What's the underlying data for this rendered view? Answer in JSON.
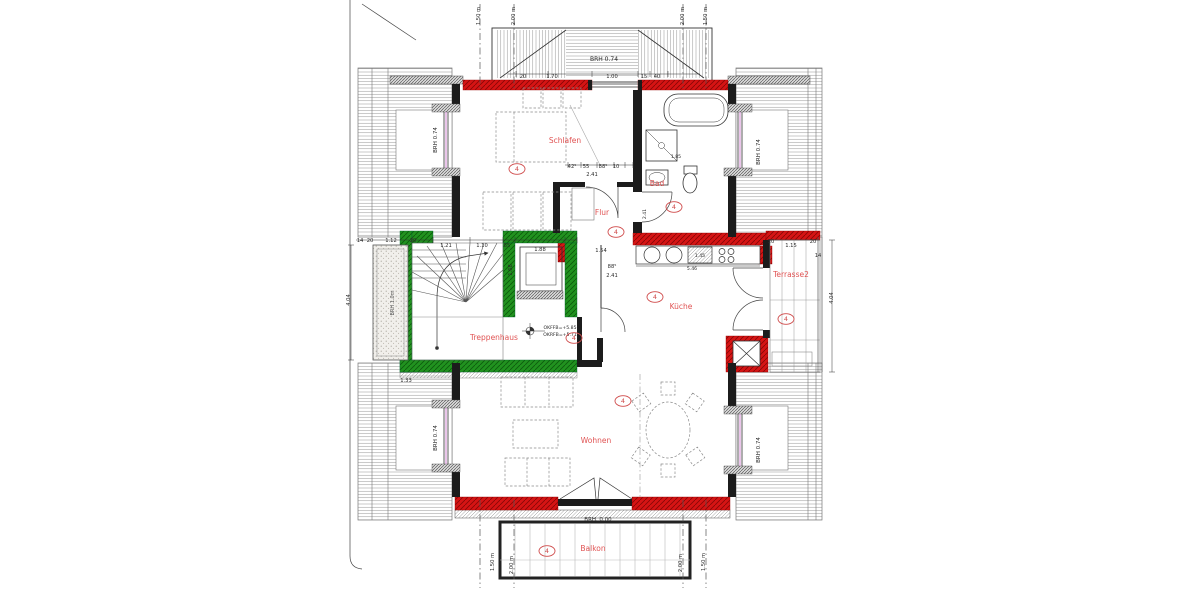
{
  "meta": {
    "title": "Dachgeschoss Wohnungsgrundriss"
  },
  "colors": {
    "wall_red": "#d61414",
    "wall_red_hatch": "#8a0606",
    "wall_green": "#21921f",
    "wall_green_hatch": "#0c5c0c",
    "room_text": "#e05353",
    "marker": "#cf4a4a",
    "ink": "#2b2b2b",
    "roof_line": "#8f8f8f",
    "glass": "#c45ac4"
  },
  "labels": {
    "rooms": [
      {
        "id": "schlafen",
        "label": "Schlafen",
        "x": 565,
        "y": 143
      },
      {
        "id": "bad",
        "label": "Bad",
        "x": 657,
        "y": 186
      },
      {
        "id": "flur",
        "label": "Flur",
        "x": 602,
        "y": 215
      },
      {
        "id": "kueche",
        "label": "Küche",
        "x": 681,
        "y": 309
      },
      {
        "id": "treppenhaus",
        "label": "Treppenhaus",
        "x": 494,
        "y": 340
      },
      {
        "id": "wohnen",
        "label": "Wohnen",
        "x": 596,
        "y": 443
      },
      {
        "id": "balkon",
        "label": "Balkon",
        "x": 593,
        "y": 551
      },
      {
        "id": "terrasse2",
        "label": "Terrasse2",
        "x": 791,
        "y": 277
      }
    ],
    "markers": [
      {
        "text": "4",
        "x": 517,
        "y": 169
      },
      {
        "text": "4",
        "x": 674,
        "y": 207
      },
      {
        "text": "4",
        "x": 616,
        "y": 232
      },
      {
        "text": "4",
        "x": 655,
        "y": 297
      },
      {
        "text": "4",
        "x": 574,
        "y": 338
      },
      {
        "text": "4",
        "x": 623,
        "y": 401
      },
      {
        "text": "4",
        "x": 547,
        "y": 551
      },
      {
        "text": "4",
        "x": 786,
        "y": 319
      }
    ],
    "dims": [
      {
        "t": "20",
        "x": 523,
        "y": 78
      },
      {
        "t": "1.70",
        "x": 552,
        "y": 78
      },
      {
        "t": "1.00",
        "x": 612,
        "y": 78
      },
      {
        "t": "15",
        "x": 644,
        "y": 78
      },
      {
        "t": "40",
        "x": 657,
        "y": 78
      },
      {
        "t": "BRH 0.74",
        "x": 604,
        "y": 61,
        "s": 6
      },
      {
        "t": "BRH 0.74",
        "x": 437,
        "y": 140,
        "r": -90,
        "s": 5.5
      },
      {
        "t": "BRH 0.74",
        "x": 437,
        "y": 438,
        "r": -90,
        "s": 5.5
      },
      {
        "t": "BRH 0.74",
        "x": 760,
        "y": 152,
        "r": -90,
        "s": 5.5
      },
      {
        "t": "BRH 0.74",
        "x": 760,
        "y": 450,
        "r": -90,
        "s": 5.5
      },
      {
        "t": "BRH. 0.00",
        "x": 598,
        "y": 521,
        "s": 5.5
      },
      {
        "t": "BRH 1.0m",
        "x": 394,
        "y": 303,
        "r": -90,
        "s": 5,
        "c": "#555555"
      },
      {
        "t": "1.50 m",
        "x": 480,
        "y": 16,
        "r": -90
      },
      {
        "t": "2.00 m",
        "x": 515,
        "y": 16,
        "r": -90
      },
      {
        "t": "2.00 m",
        "x": 684,
        "y": 16,
        "r": -90
      },
      {
        "t": "1.50 m",
        "x": 707,
        "y": 16,
        "r": -90
      },
      {
        "t": "1.50 m",
        "x": 494,
        "y": 562,
        "r": -90
      },
      {
        "t": "2.00 m",
        "x": 513,
        "y": 565,
        "r": -90
      },
      {
        "t": "2.00 m",
        "x": 682,
        "y": 563,
        "r": -90
      },
      {
        "t": "1.50 m",
        "x": 705,
        "y": 562,
        "r": -90
      },
      {
        "t": "4.04",
        "x": 350,
        "y": 300,
        "r": -90
      },
      {
        "t": "4.04",
        "x": 833,
        "y": 298,
        "r": -90
      },
      {
        "t": "14",
        "x": 360,
        "y": 242
      },
      {
        "t": "20",
        "x": 370,
        "y": 242
      },
      {
        "t": "1.12",
        "x": 391,
        "y": 242
      },
      {
        "t": "20",
        "x": 413,
        "y": 242
      },
      {
        "t": "1.21",
        "x": 446,
        "y": 247
      },
      {
        "t": "1.10",
        "x": 482,
        "y": 247
      },
      {
        "t": "55",
        "x": 507,
        "y": 247
      },
      {
        "t": "1.88",
        "x": 540,
        "y": 251
      },
      {
        "t": "1.68",
        "x": 512,
        "y": 270,
        "r": -90
      },
      {
        "t": "1.33",
        "x": 406,
        "y": 382
      },
      {
        "t": "42⁵",
        "x": 572,
        "y": 168
      },
      {
        "t": "55",
        "x": 586,
        "y": 168
      },
      {
        "t": "88⁵",
        "x": 603,
        "y": 168
      },
      {
        "t": "10",
        "x": 616,
        "y": 168
      },
      {
        "t": "2.41",
        "x": 592,
        "y": 176
      },
      {
        "t": "1.54",
        "x": 601,
        "y": 252
      },
      {
        "t": "88⁵",
        "x": 612,
        "y": 268
      },
      {
        "t": "2.41",
        "x": 612,
        "y": 277
      },
      {
        "t": "1.45",
        "x": 700,
        "y": 257,
        "s": 4.6
      },
      {
        "t": "5.46",
        "x": 692,
        "y": 270,
        "s": 4.6
      },
      {
        "t": "1.15",
        "x": 791,
        "y": 247
      },
      {
        "t": "20",
        "x": 771,
        "y": 243
      },
      {
        "t": "20",
        "x": 813,
        "y": 243
      },
      {
        "t": "14",
        "x": 818,
        "y": 257
      },
      {
        "t": "1.85",
        "x": 676,
        "y": 158,
        "s": 4.6
      },
      {
        "t": "2.41",
        "x": 646,
        "y": 214,
        "r": -90,
        "s": 4.6
      },
      {
        "t": "OKFFB=+5.85",
        "x": 560,
        "y": 329,
        "s": 4.6
      },
      {
        "t": "OKRFB=+5.71",
        "x": 560,
        "y": 336,
        "s": 4.6
      }
    ]
  }
}
